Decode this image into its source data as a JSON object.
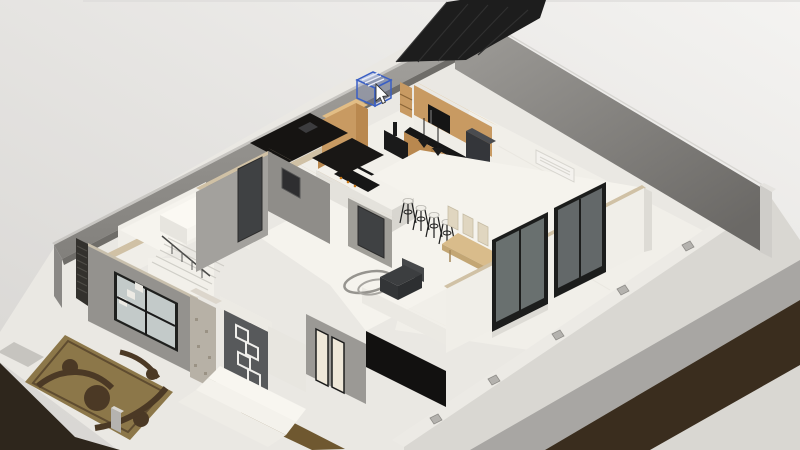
{
  "view": {
    "name": "3d-floorplan-viewport",
    "projection": "isometric-cutaway",
    "width": 800,
    "height": 450
  },
  "colors": {
    "background_top": "#f4f3f1",
    "background_bottom": "#d7d5d2",
    "roof": "#1d1d1d",
    "boundary_wall_gray": "#8f8d89",
    "wall_white": "#f0eee8",
    "wall_cut_edge": "#d0c1a5",
    "wall_gray": "#94928e",
    "cabinet_wood": "#c89a62",
    "cabinet_wood_dark": "#b9884f",
    "countertop": "#161616",
    "floor_light": "#eae8e3",
    "floor_marble": "#f5f3ed",
    "soil": "#3a2d1e",
    "rug_base": "#8c7749",
    "rug_pattern": "#4b3925",
    "selection_blue": "#3a5fc4",
    "glass": "#aab4b5",
    "door_panel": "#57595b",
    "door_dark": "#3f4143",
    "seat_dark": "#3c3e40",
    "dining_wood": "#d9bc8b",
    "chair_beige": "#e0d6c0"
  },
  "cursor": {
    "type": "arrow-pointer",
    "x": 376,
    "y": 84
  },
  "selection_box": {
    "x": 357,
    "y": 72,
    "width": 34,
    "height": 34,
    "location": "kitchen-upper-cabinets"
  },
  "scene": {
    "rooms": [
      "kitchen",
      "dining-area",
      "living-area",
      "bedroom",
      "bathroom",
      "hallway",
      "staircase",
      "entry-porch",
      "front-garden",
      "side-courtyard",
      "garage"
    ],
    "furniture": [
      "kitchen-cabinets",
      "microwave",
      "cooker-hood",
      "refrigerator",
      "kitchen-island",
      "bar-stools",
      "pendant-lights",
      "dining-table",
      "dining-chairs",
      "armchair",
      "wire-rug",
      "area-rug",
      "air-conditioner",
      "entry-door",
      "staircase-railing"
    ]
  }
}
